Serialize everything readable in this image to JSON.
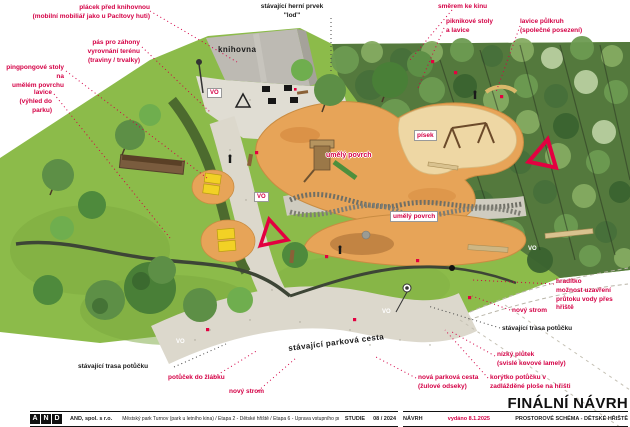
{
  "colors": {
    "annotation_red": "#d40045",
    "label_black": "#1a1a1a",
    "grass": "#8cbb4a",
    "canopy_dark": "#54793d",
    "surface_orange": "#e7a458",
    "sand": "#eed7a4",
    "path": "#dcd8cc",
    "building_gray": "#bdbab3"
  },
  "plan": {
    "building_label": "knihovna",
    "surface_label_1": "umělý povrch",
    "surface_label_2": "umělý povrch",
    "sand_label": "písek",
    "existing_path_label": "stávající parková cesta",
    "vo_label": "VO"
  },
  "annotations": {
    "placek": "plácek před knihovnou\n(mobilní mobiliář jako u Pacltovy huti)",
    "pas": "pás pro záhony\nvyrovnání terénu\n(traviny / trvalky)",
    "pingpong": "pingpongové stoly na\numělém povrchu",
    "lavice": "lavice\n(výhled do parku)",
    "herni_prvek": "stávající herní prvek\n\"loď\"",
    "smerem": "směrem ke kinu",
    "piknik": "piknikové stoly\na lavice",
    "lavice_pulkruh": "lavice půlkruh\n(společné posezení)",
    "hraditko": "hradítko\nmožnost uzavření\nprůtoku vody přes hřiště",
    "novy_strom_r": "nový strom",
    "trasa_potucku_r": "stávající trasa potůčku",
    "nizky_plutek": "nízký plůtek\n(svislé kovové lamely)",
    "korytko": "korýtko potůčku v\nzadlážděné ploše na hřišti",
    "nova_cesta": "nová parková cesta\n(žulové odseky)",
    "novy_strom_b": "nový strom",
    "potucek_zlabek": "potůček do žlábku",
    "trasa_potucku_l": "stávající trasa potůčku"
  },
  "footer": {
    "logo_letters": [
      "A",
      "N",
      "D"
    ],
    "firm": "AND, spol. s r.o.",
    "project": "Městský park Turnov (park u letního kina) / Etapa 2 - Dětské hřiště / Etapa 6 - Úprava vstupního prostoru Muzea Českého ráje",
    "phase": "STUDIE",
    "date": "08 / 2024",
    "stage": "NÁVRH",
    "issued": "vydáno 8.1.2025",
    "sheet": "PROSTOROVÉ SCHÉMA - DĚTSKÉ HŘIŠTĚ",
    "title": "FINÁLNÍ NÁVRH"
  }
}
